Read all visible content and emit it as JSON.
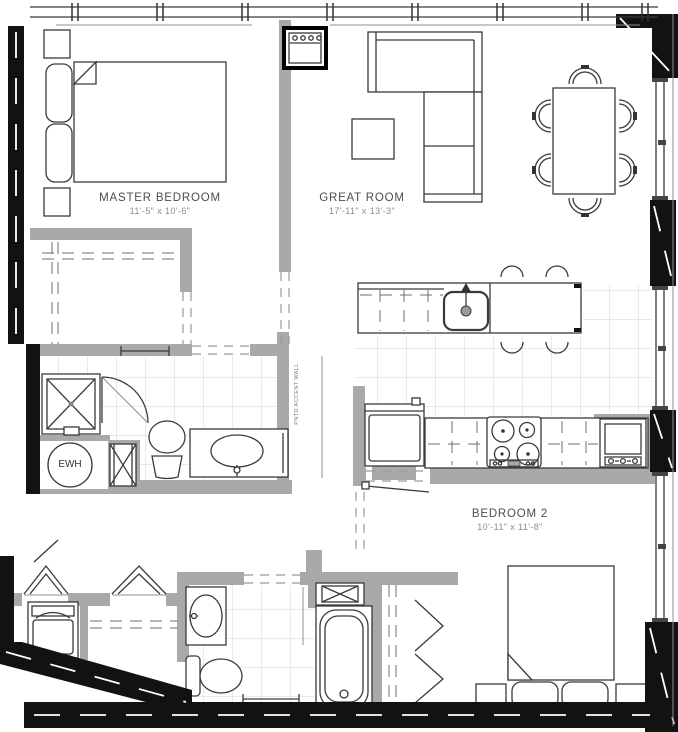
{
  "rooms": [
    {
      "name": "MASTER BEDROOM",
      "dims": "11'-5\" x 10'-6\""
    },
    {
      "name": "GREAT ROOM",
      "dims": "17'-11\" x 13'-3\""
    },
    {
      "name": "BEDROOM 2",
      "dims": "10'-11\" x 11'-8\""
    }
  ],
  "labels": {
    "water_heater": "EWH",
    "accent_wall": "PNTD ACCENT WALL"
  },
  "colors": {
    "exterior_wall": "#121212",
    "interior_wall": "#a9a9a9",
    "line": "#3a3a3a",
    "tile_line": "#d4d4d4",
    "background": "#ffffff",
    "room_text": "#4d4d4d",
    "dim_text": "#8c8c8c"
  },
  "fixtures": [
    "bed",
    "pillow",
    "nightstand",
    "sectional-sofa",
    "coffee-table",
    "dining-table",
    "dining-chair",
    "bar-stool",
    "kitchen-island",
    "island-sink",
    "refrigerator",
    "cooktop",
    "wall-oven",
    "shower",
    "shower-door",
    "toilet",
    "vanity-sink",
    "bathtub",
    "towel-bar",
    "water-heater",
    "utility-shaft",
    "mechanical-unit",
    "washer-dryer",
    "bifold-closet-door",
    "closet-shelf",
    "window",
    "door-opening"
  ]
}
